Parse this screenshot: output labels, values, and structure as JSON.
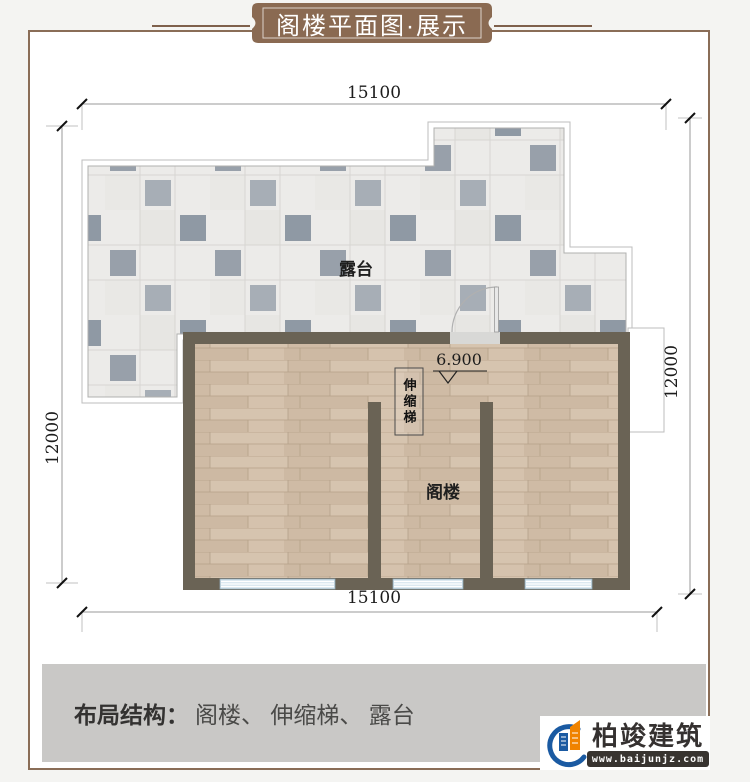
{
  "banner": {
    "title": "阁楼平面图·展示"
  },
  "plan": {
    "dimensions": {
      "top": "15100",
      "bottom": "15100",
      "left": "12000",
      "right": "12000"
    },
    "labels": {
      "terrace": "露台",
      "attic": "阁楼",
      "ladder": "伸缩梯",
      "elevation": "6.900"
    }
  },
  "footer": {
    "label": "布局结构：",
    "value": "阁楼、 伸缩梯、 露台"
  },
  "logo": {
    "name": "柏竣建筑",
    "website": "www.baijunjz.com"
  },
  "colors": {
    "banner_brown": "#8a6a52",
    "wall": "#6a6355",
    "wood_floor": "#d6c4af",
    "tile_dark": "#98a0aa",
    "window_blue": "#d7e6ef",
    "footer_gray": "#c9c8c6",
    "logo_blue": "#1a5aa2",
    "logo_orange": "#f08300"
  }
}
